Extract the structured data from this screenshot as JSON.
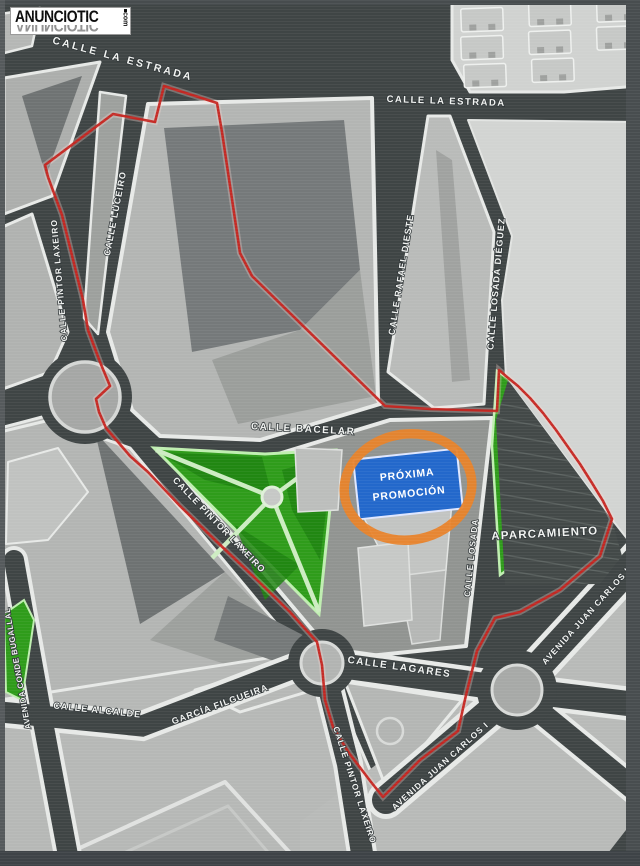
{
  "watermark": {
    "brand": "ANUNCIOTIC",
    "tld": "com"
  },
  "promo": {
    "line1": "PRÓXIMA",
    "line2": "PROMOCIÓN"
  },
  "areas": {
    "parking": "APARCAMIENTO"
  },
  "streets": {
    "la_estrada": "CALLE LA ESTRADA",
    "luceiro": "CALLE LUCEIRO",
    "pintor_laxeiro": "CALLE PINTOR LAXEIRO",
    "rafael_dieste": "CALLE RAFAEL DIESTE",
    "losada_dieguez": "CALLE LOSADA DIÉGUEZ",
    "losada": "CALLE LOSADA",
    "bacelar": "CALLE BACELAR",
    "lagares": "CALLE LAGARES",
    "juan_carlos_i": "AVENIDA JUAN CARLOS I",
    "alcalde": "CALLE ALCALDE",
    "garcia_filgueira": "GARCÍA FILGUEIRA",
    "conde_bugallal": "AVENIDA CONDE BUGALLAL"
  },
  "colors": {
    "boundary_red": "#c5241f",
    "highlight_orange": "#e8832b",
    "promo_blue": "#2368cb",
    "park_green": "#2f9c1b",
    "street_dark": "#3f4545",
    "block_light": "#b6b8b6"
  }
}
